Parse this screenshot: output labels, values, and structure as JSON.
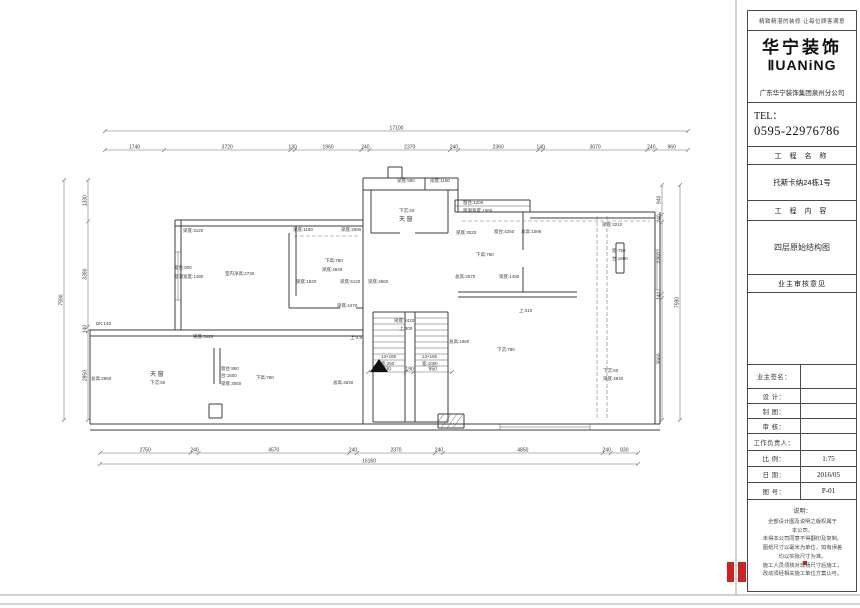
{
  "colors": {
    "red": "#cc2222",
    "line": "#3c3c3c"
  },
  "sheet": {
    "slogan": "精致精湛的装修 让每位顾客满意",
    "logo_cn": "华宁装饰",
    "logo_en": "ⅡUANiNG",
    "company": "广东华宁装饰集团泉州分公司",
    "tel_label": "TEL：",
    "tel_number": "0595-22976786",
    "section1_header": "工 程 名 称",
    "project_name": "托斯卡纳24栋1号",
    "section2_header": "工 程 内 容",
    "project_content": "四层原始结构图",
    "section3_header": "业主审核意见",
    "rows": [
      {
        "label": "业主签名：",
        "value": ""
      },
      {
        "label": "设  计：",
        "value": ""
      },
      {
        "label": "制  图：",
        "value": ""
      },
      {
        "label": "审  核：",
        "value": ""
      },
      {
        "label": "工作负责人：",
        "value": ""
      },
      {
        "label": "比  例：",
        "value": "1:75"
      },
      {
        "label": "日  期：",
        "value": "2016/05"
      },
      {
        "label": "图  号：",
        "value": "P-01"
      }
    ],
    "notes_title": "说明：",
    "notes_lines": [
      "全部设计图及说明之版权属于",
      "本公司，",
      "未得本公司同意不得翻印及复制。",
      "图纸尺寸以毫米为单位，如有误差",
      "均以实际尺寸为准。",
      "施工人员须核对现场尺寸后施工，",
      "改动须经相关施工单位方案认可。"
    ]
  },
  "plan": {
    "dims": [
      {
        "orient": "h",
        "at": 131,
        "start": 105,
        "end": 688,
        "segments": [
          17100
        ]
      },
      {
        "orient": "h",
        "at": 150,
        "start": 105,
        "end": 688,
        "segments": [
          1740,
          3720,
          130,
          1960,
          240,
          2370,
          240,
          2360,
          140,
          3070,
          240,
          960
        ]
      },
      {
        "orient": "h",
        "at": 453,
        "start": 100,
        "end": 638,
        "segments": [
          2750,
          240,
          4570,
          240,
          2370,
          240,
          4850,
          240,
          830
        ]
      },
      {
        "orient": "h",
        "at": 464,
        "start": 100,
        "end": 638,
        "segments": [
          16160
        ]
      },
      {
        "orient": "v",
        "at": 88,
        "start": 180,
        "end": 420,
        "segments": [
          1330,
          3380,
          140,
          2850
        ]
      },
      {
        "orient": "v",
        "at": 64,
        "start": 180,
        "end": 420,
        "segments": [
          7590
        ]
      },
      {
        "orient": "v",
        "at": 662,
        "start": 185,
        "end": 420,
        "segments": [
          940,
          240,
          2260,
          140,
          3860
        ]
      },
      {
        "orient": "v",
        "at": 680,
        "start": 185,
        "end": 420,
        "segments": [
          7590
        ]
      },
      {
        "orient": "h",
        "at": 372,
        "start": 368,
        "end": 452,
        "segments": [
          930,
          190,
          950
        ]
      }
    ],
    "walls": [
      [
        175,
        220,
        363,
        220
      ],
      [
        175,
        226,
        363,
        226
      ],
      [
        175,
        220,
        175,
        330
      ],
      [
        181,
        220,
        181,
        330
      ],
      [
        90,
        330,
        363,
        330
      ],
      [
        90,
        336,
        363,
        336
      ],
      [
        90,
        330,
        90,
        424
      ],
      [
        90,
        424,
        660,
        424
      ],
      [
        90,
        430,
        660,
        430
      ],
      [
        655,
        212,
        655,
        424
      ],
      [
        660,
        212,
        660,
        424
      ],
      [
        530,
        212,
        655,
        212
      ],
      [
        530,
        218,
        655,
        218
      ],
      [
        455,
        200,
        530,
        200
      ],
      [
        455,
        212,
        530,
        212
      ],
      [
        455,
        200,
        455,
        212
      ],
      [
        530,
        200,
        530,
        212
      ],
      [
        363,
        178,
        363,
        424
      ],
      [
        363,
        178,
        458,
        178
      ],
      [
        363,
        190,
        458,
        190
      ],
      [
        425,
        178,
        425,
        190
      ],
      [
        458,
        178,
        458,
        212
      ],
      [
        388,
        167,
        402,
        167
      ],
      [
        388,
        167,
        388,
        178
      ],
      [
        402,
        167,
        402,
        178
      ],
      [
        371,
        190,
        371,
        233
      ],
      [
        448,
        190,
        448,
        233
      ],
      [
        371,
        233,
        400,
        233
      ],
      [
        415,
        233,
        448,
        233
      ],
      [
        296,
        226,
        296,
        296
      ],
      [
        289,
        233,
        289,
        308
      ],
      [
        289,
        308,
        340,
        308
      ],
      [
        356,
        308,
        363,
        308
      ],
      [
        214,
        348,
        214,
        384
      ],
      [
        220,
        348,
        220,
        384
      ],
      [
        209,
        404,
        222,
        404
      ],
      [
        209,
        404,
        209,
        418
      ],
      [
        222,
        404,
        222,
        418
      ],
      [
        209,
        418,
        222,
        418
      ],
      [
        523,
        212,
        523,
        250
      ],
      [
        523,
        267,
        523,
        292
      ],
      [
        458,
        292,
        577,
        292
      ],
      [
        458,
        297,
        577,
        297
      ],
      [
        616,
        243,
        624,
        243
      ],
      [
        616,
        273,
        624,
        273
      ],
      [
        616,
        243,
        616,
        273
      ],
      [
        624,
        243,
        624,
        273
      ],
      [
        373,
        312,
        448,
        312
      ],
      [
        373,
        312,
        373,
        422
      ],
      [
        448,
        312,
        448,
        422
      ],
      [
        405,
        312,
        405,
        422
      ],
      [
        415,
        312,
        415,
        422
      ],
      [
        373,
        422,
        448,
        422
      ],
      [
        438,
        414,
        464,
        414
      ],
      [
        438,
        428,
        464,
        428
      ],
      [
        438,
        414,
        438,
        428
      ],
      [
        464,
        414,
        464,
        428
      ]
    ],
    "thin": [
      [
        373,
        318,
        405,
        318
      ],
      [
        373,
        324,
        405,
        324
      ],
      [
        373,
        330,
        405,
        330
      ],
      [
        373,
        336,
        405,
        336
      ],
      [
        373,
        342,
        405,
        342
      ],
      [
        373,
        348,
        405,
        348
      ],
      [
        373,
        354,
        405,
        354
      ],
      [
        373,
        360,
        405,
        360
      ],
      [
        373,
        366,
        405,
        366
      ],
      [
        415,
        318,
        448,
        318
      ],
      [
        415,
        324,
        448,
        324
      ],
      [
        415,
        330,
        448,
        330
      ],
      [
        415,
        336,
        448,
        336
      ],
      [
        415,
        342,
        448,
        342
      ],
      [
        415,
        348,
        448,
        348
      ],
      [
        415,
        354,
        448,
        354
      ],
      [
        415,
        360,
        448,
        360
      ],
      [
        415,
        366,
        448,
        366
      ],
      [
        178,
        252,
        178,
        300
      ],
      [
        175,
        252,
        181,
        252
      ],
      [
        175,
        300,
        181,
        300
      ],
      [
        455,
        206,
        530,
        206
      ],
      [
        657,
        250,
        657,
        290
      ],
      [
        655,
        250,
        660,
        250
      ],
      [
        655,
        290,
        660,
        290
      ],
      [
        500,
        427,
        590,
        427
      ],
      [
        500,
        424,
        500,
        430
      ],
      [
        590,
        424,
        590,
        430
      ],
      [
        441,
        428,
        451,
        414
      ],
      [
        447,
        428,
        457,
        414
      ],
      [
        453,
        428,
        463,
        414
      ],
      [
        438,
        422,
        444,
        414
      ]
    ],
    "dashed": [
      [
        294,
        236,
        360,
        236
      ],
      [
        462,
        221,
        650,
        221
      ],
      [
        597,
        216,
        597,
        420
      ],
      [
        607,
        216,
        607,
        420
      ]
    ],
    "frame": [
      [
        736,
        0,
        736,
        595
      ],
      [
        0,
        595,
        860,
        595
      ],
      [
        0,
        604,
        860,
        604
      ]
    ],
    "stair_arrow": [
      [
        370,
        372
      ],
      [
        388,
        372
      ],
      [
        379,
        359
      ]
    ],
    "red_marks": [
      [
        727,
        562,
        7,
        20
      ],
      [
        738,
        562,
        8,
        20
      ],
      [
        803,
        561,
        4,
        4
      ]
    ],
    "annotations": [
      [
        "梁底:3120",
        183,
        232
      ],
      [
        "窗台:900",
        174,
        269
      ],
      [
        "窗洞宽度:1490",
        174,
        278
      ],
      [
        "室内净高:2730",
        225,
        275
      ],
      [
        "梁底:4840",
        322,
        271
      ],
      [
        "梁底:1190",
        293,
        231
      ],
      [
        "梁底:2600",
        341,
        231
      ],
      [
        "下高:780",
        325,
        262
      ],
      [
        "梁底:1820",
        296,
        283
      ],
      [
        "梁底:5120",
        340,
        283
      ],
      [
        "梁底:4960",
        368,
        283
      ],
      [
        "梁底:4470",
        337,
        307
      ],
      [
        "梁底:580",
        397,
        182
      ],
      [
        "梁底:1190",
        430,
        182
      ],
      [
        "下沉:20",
        399,
        212
      ],
      [
        "天 窗",
        399,
        221,
        6
      ],
      [
        "梁底:2420",
        394,
        322
      ],
      [
        "上:300",
        399,
        330
      ],
      [
        "13×180",
        381,
        358
      ],
      [
        "宽:250",
        381,
        365
      ],
      [
        "13×180",
        422,
        358
      ],
      [
        "宽:1050",
        422,
        365
      ],
      [
        "总高:1960",
        449,
        343
      ],
      [
        "窗台:1200",
        463,
        204
      ],
      [
        "窗洞宽度:1560",
        463,
        212
      ],
      [
        "梁底:3020",
        456,
        234
      ],
      [
        "窗台:4250",
        494,
        233
      ],
      [
        "总高:1098",
        521,
        233
      ],
      [
        "下高:780",
        476,
        256
      ],
      [
        "总高:2570",
        455,
        278
      ],
      [
        "梁底:1480",
        499,
        278
      ],
      [
        "梁底:3210",
        602,
        226
      ],
      [
        "窗-750",
        612,
        252
      ],
      [
        "台:1800",
        612,
        260
      ],
      [
        "上:310",
        519,
        312
      ],
      [
        "下高:780",
        256,
        379
      ],
      [
        "总高:4840",
        333,
        384
      ],
      [
        "天 窗",
        150,
        376,
        6
      ],
      [
        "下沉:50",
        150,
        384
      ],
      [
        "总高:2850",
        91,
        380
      ],
      [
        "梁底:3120",
        193,
        338
      ],
      [
        "窗台:950",
        221,
        370
      ],
      [
        "台:1500",
        221,
        377
      ],
      [
        "梁底:3050",
        221,
        385
      ],
      [
        "DK:140",
        96,
        325
      ],
      [
        "下沉:780",
        497,
        351
      ],
      [
        "下沉:50",
        603,
        372
      ],
      [
        "梁底:4840",
        603,
        380
      ],
      [
        "上:4.8",
        350,
        339
      ]
    ]
  }
}
